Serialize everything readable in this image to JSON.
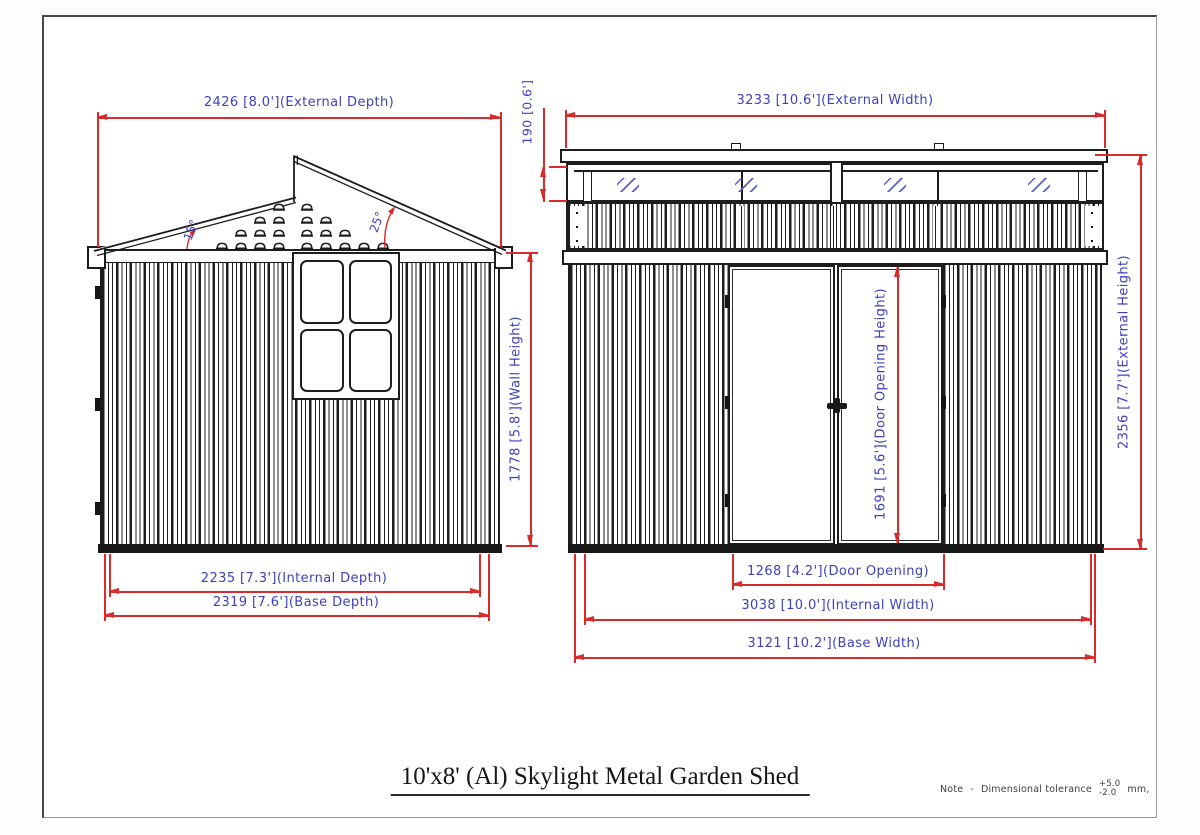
{
  "drawing": {
    "title": "10'x8' (Al) Skylight Metal Garden Shed",
    "note": {
      "label": "Note",
      "separator": "-",
      "text": "Dimensional tolerance",
      "tolerance_plus": "+5.0",
      "tolerance_minus": "-2.0",
      "unit": "mm,"
    },
    "colors": {
      "line": "#1d1d1d",
      "dimension": "#d92b2b",
      "text": "#4040bd"
    },
    "side_view": {
      "dims": {
        "external_depth": "2426 [8.0'](External Depth)",
        "wall_height": "1778 [5.8'](Wall Height)",
        "internal_depth": "2235 [7.3'](Internal Depth)",
        "base_depth": "2319 [7.6'](Base Depth)",
        "roof_angle_left": "15°",
        "roof_angle_right": "25°"
      }
    },
    "front_view": {
      "dims": {
        "external_width": "3233 [10.6'](External Width)",
        "skylight_height": "190 [0.6']",
        "external_height": "2356 [7.7'](External Height)",
        "door_opening_height": "1691 [5.6'](Door Opening Height)",
        "door_opening": "1268 [4.2'](Door Opening)",
        "internal_width": "3038 [10.0'](Internal Width)",
        "base_width": "3121 [10.2'](Base Width)"
      }
    }
  }
}
